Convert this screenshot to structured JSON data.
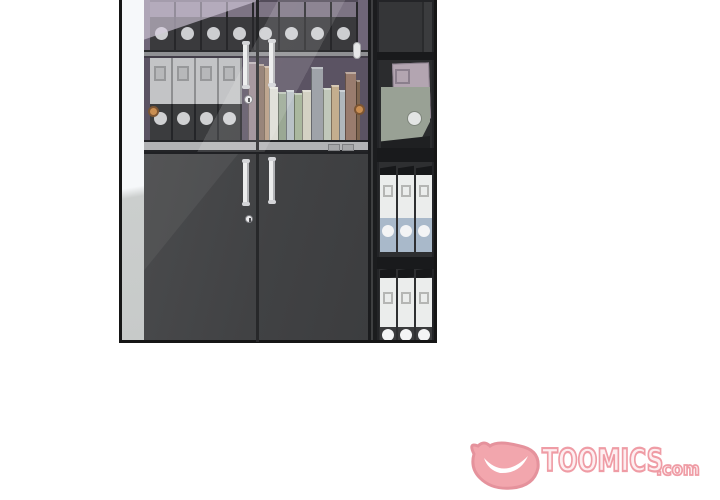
{
  "watermark": {
    "brand": "TOOMICS",
    "suffix": ".com",
    "fill_color": "#fdeef0",
    "outline_color": "#ef98a2",
    "mascot_fill": "#f2a3aa",
    "mascot_outline": "#e48e98"
  },
  "scene": {
    "panel_border_color": "#161616",
    "wall_highlight": "#f6f8fa",
    "wall_shade": "#cbcecd",
    "cabinet_body": "#424345",
    "cabinet_backwall_top": "#6f6678",
    "cabinet_backwall_lower": "#5b5363",
    "door_handle_color": "#eceded",
    "door_knob_color": "#c98e52",
    "top_shelf_binders": {
      "count": 8,
      "spine_top": "#7d7484",
      "spine_body": "#3a3a3d",
      "hole": "#cdced1",
      "divider": "#27272a"
    },
    "gray_binders": {
      "count": 4,
      "body": "#c3c4c6",
      "band": "#3b3c3e",
      "hole": "#cfd0d2",
      "window_fill": "#b7b8ba",
      "window_edge": "#97989a"
    },
    "books": [
      {
        "x": 0,
        "w": 10,
        "top": 4,
        "color": "#9a8a92"
      },
      {
        "x": 10,
        "w": 6,
        "top": 6,
        "color": "#8a7468"
      },
      {
        "x": 16,
        "w": 5,
        "top": 8,
        "color": "#b59a80"
      },
      {
        "x": 21,
        "w": 9,
        "top": 29,
        "color": "#ddddd5"
      },
      {
        "x": 30,
        "w": 8,
        "top": 34,
        "color": "#9aa894"
      },
      {
        "x": 38,
        "w": 8,
        "top": 32,
        "color": "#b9c2c6"
      },
      {
        "x": 46,
        "w": 8,
        "top": 35,
        "color": "#aab89e"
      },
      {
        "x": 54,
        "w": 9,
        "top": 32,
        "color": "#d4d2c4"
      },
      {
        "x": 63,
        "w": 12,
        "top": 9,
        "color": "#9fa3a9"
      },
      {
        "x": 75,
        "w": 8,
        "top": 30,
        "color": "#c0c8ba"
      },
      {
        "x": 83,
        "w": 8,
        "top": 27,
        "color": "#c4ae8e"
      },
      {
        "x": 91,
        "w": 6,
        "top": 32,
        "color": "#b0b8bd"
      },
      {
        "x": 97,
        "w": 11,
        "top": 14,
        "color": "#997c6e"
      },
      {
        "x": 108,
        "w": 4,
        "top": 22,
        "color": "#7e6550"
      }
    ],
    "right_shelf": {
      "frame": "#232427",
      "compartment_bg": "#2e2f31",
      "empty_bg": "#353638",
      "white_binders_count": 3,
      "white_binder": {
        "body": "#ebedec",
        "window_edge": "#b5b6b4",
        "band_blue": "#a9b9ca",
        "band_dark": "#3a3b3d",
        "hole": "#f3f4f5",
        "top_edge": "#17181a"
      },
      "leaning_binders": {
        "mauve": "#b3a5b1",
        "sage": "#99a195",
        "hole": "#e3e5e4"
      }
    }
  }
}
